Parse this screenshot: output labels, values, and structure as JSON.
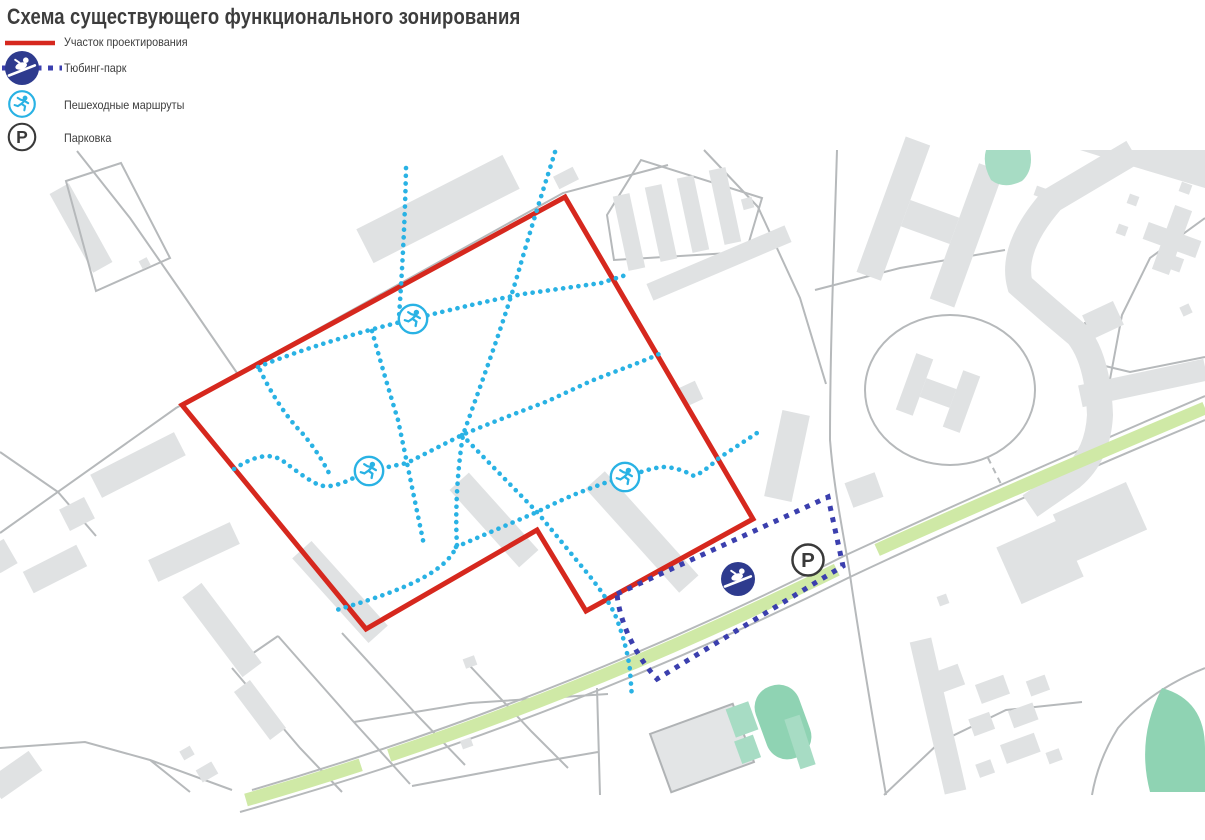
{
  "title": "Схема существующего функционального зонирования",
  "legend": {
    "items": [
      {
        "id": "site",
        "label": "Участок проектирования",
        "symbol": "red-solid-line",
        "color": "#d6281e"
      },
      {
        "id": "tubing-park",
        "label": "Тюбинг-парк",
        "symbol": "tubing-icon-with-dashed-line",
        "color": "#3b3fae"
      },
      {
        "id": "pedestrian-routes",
        "label": "Пешеходные маршруты",
        "symbol": "runner-icon",
        "color": "#29b2e4"
      },
      {
        "id": "parking",
        "label": "Парковка",
        "symbol": "parking-icon",
        "color": "#3a3a3a"
      }
    ]
  },
  "map": {
    "parking_label": "P",
    "marker_counts": {
      "pedestrian_route_icons": 3,
      "tubing_park_icons": 1,
      "parking_icons": 1
    },
    "colors": {
      "site_outline": "#d6281e",
      "pedestrian_route": "#29b2e4",
      "tubing_park_outline": "#3b3fae",
      "tubing_icon_fill": "#2e3b8e",
      "parking_icon": "#3a3a3a",
      "building_fill": "#e0e2e3",
      "road_line": "#b6b9bb",
      "green_strip": "#cfe9a6",
      "recreation_teal": "#93d5b6",
      "text": "#3d3d3d"
    }
  }
}
